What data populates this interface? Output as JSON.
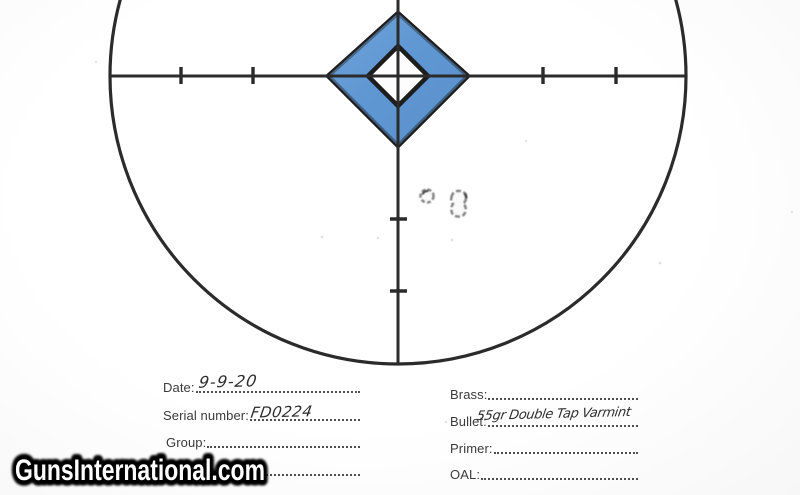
{
  "watermark": {
    "text": "GunsInternational.com"
  },
  "form": {
    "left": [
      {
        "label": "Date:",
        "value": "9-9-20"
      },
      {
        "label": "Serial number:",
        "value": "FD0224"
      },
      {
        "label": "Group:",
        "value": ""
      },
      {
        "label": "Powder:",
        "value": ""
      }
    ],
    "right": [
      {
        "label": "Brass:",
        "value": ""
      },
      {
        "label": "Bullet:",
        "value": "55gr Double Tap Varmint"
      },
      {
        "label": "Primer:",
        "value": ""
      },
      {
        "label": "OAL:",
        "value": ""
      }
    ]
  },
  "target": {
    "diamond_blue": "#5f97d3",
    "diamond_blue_light": "#7fb0e0",
    "line_color": "#2b2b2b",
    "outline_color": "#1d1d1d",
    "hole_color": "#868686",
    "bullet_hole_count": "2"
  }
}
